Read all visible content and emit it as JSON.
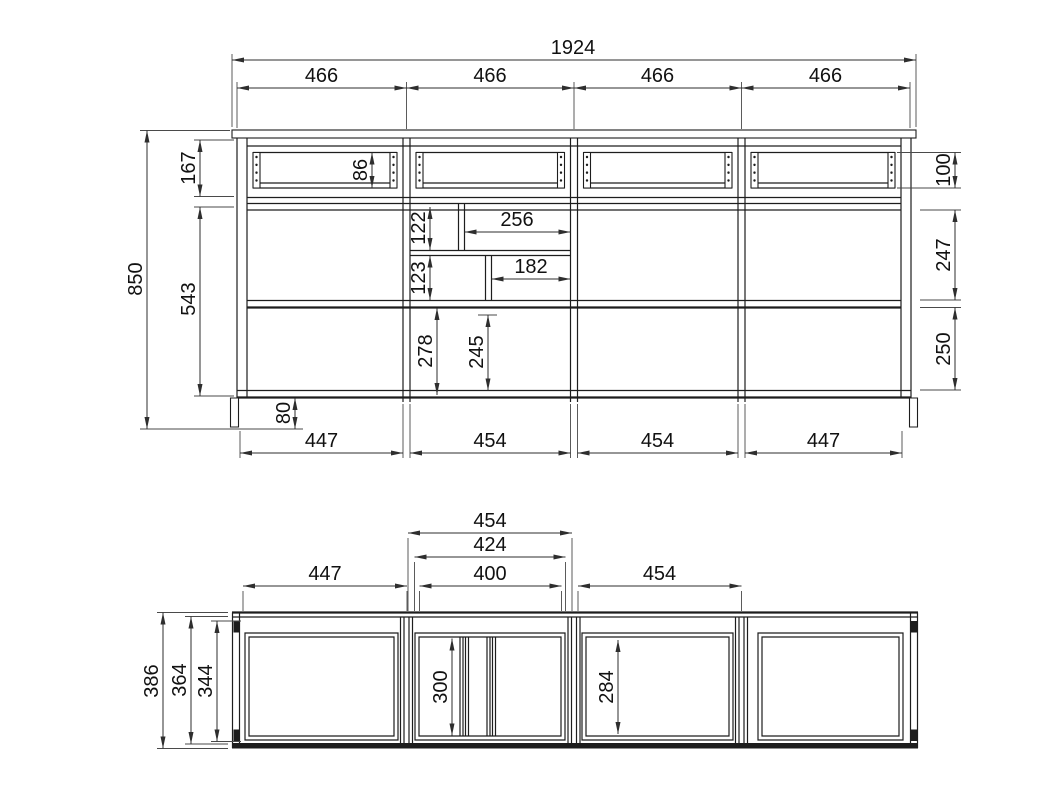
{
  "front_view": {
    "overall_width": "1924",
    "section_widths": [
      "466",
      "466",
      "466",
      "466"
    ],
    "overall_height": "850",
    "top_row_height": "167",
    "carcass_height": "543",
    "drawer_box_height": "86",
    "drawer_front_height": "100",
    "middle_compartment_height": "247",
    "lower_compartment_height": "250",
    "niche_top_height": "122",
    "niche_top_width": "256",
    "niche_mid_height": "123",
    "niche_mid_width": "182",
    "lower_niche_height_outer": "278",
    "lower_niche_height_inner": "245",
    "leg_height": "80",
    "bottom_widths": [
      "447",
      "454",
      "454",
      "447"
    ]
  },
  "top_view": {
    "module_width": "454",
    "frame_outer_width": "424",
    "frame_inner_width": "400",
    "left_module_width": "447",
    "right_module_width": "454",
    "overall_depth": "386",
    "carcass_depth": "364",
    "interior_depth": "344",
    "drawer_depth_left": "300",
    "drawer_depth_right": "284"
  },
  "colors": {
    "line": "#1d1d1d",
    "dimension": "#2e2e2e",
    "background": "#ffffff"
  }
}
